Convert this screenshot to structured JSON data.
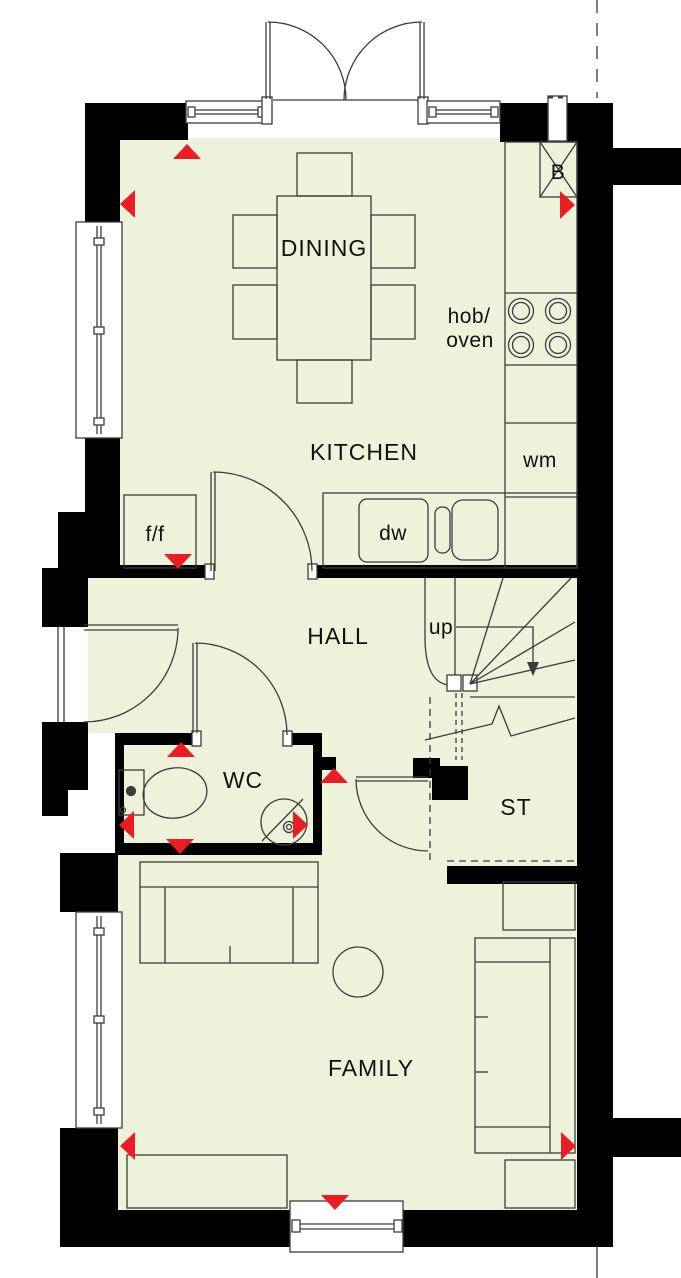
{
  "plan": {
    "rooms": {
      "dining": "DINING",
      "kitchen": "KITCHEN",
      "hall": "HALL",
      "wc": "WC",
      "store": "ST",
      "family": "FAMILY"
    },
    "labels": {
      "hob_line1": "hob/",
      "hob_line2": "oven",
      "washing_machine": "wm",
      "dishwasher": "dw",
      "fridge_freezer": "f/f",
      "boiler": "B",
      "stairs_direction": "up"
    },
    "colors": {
      "floor": "#edf2da",
      "wall": "#000000",
      "marker": "#ec1c24",
      "line": "#3c3c3c",
      "text": "#111111"
    }
  }
}
